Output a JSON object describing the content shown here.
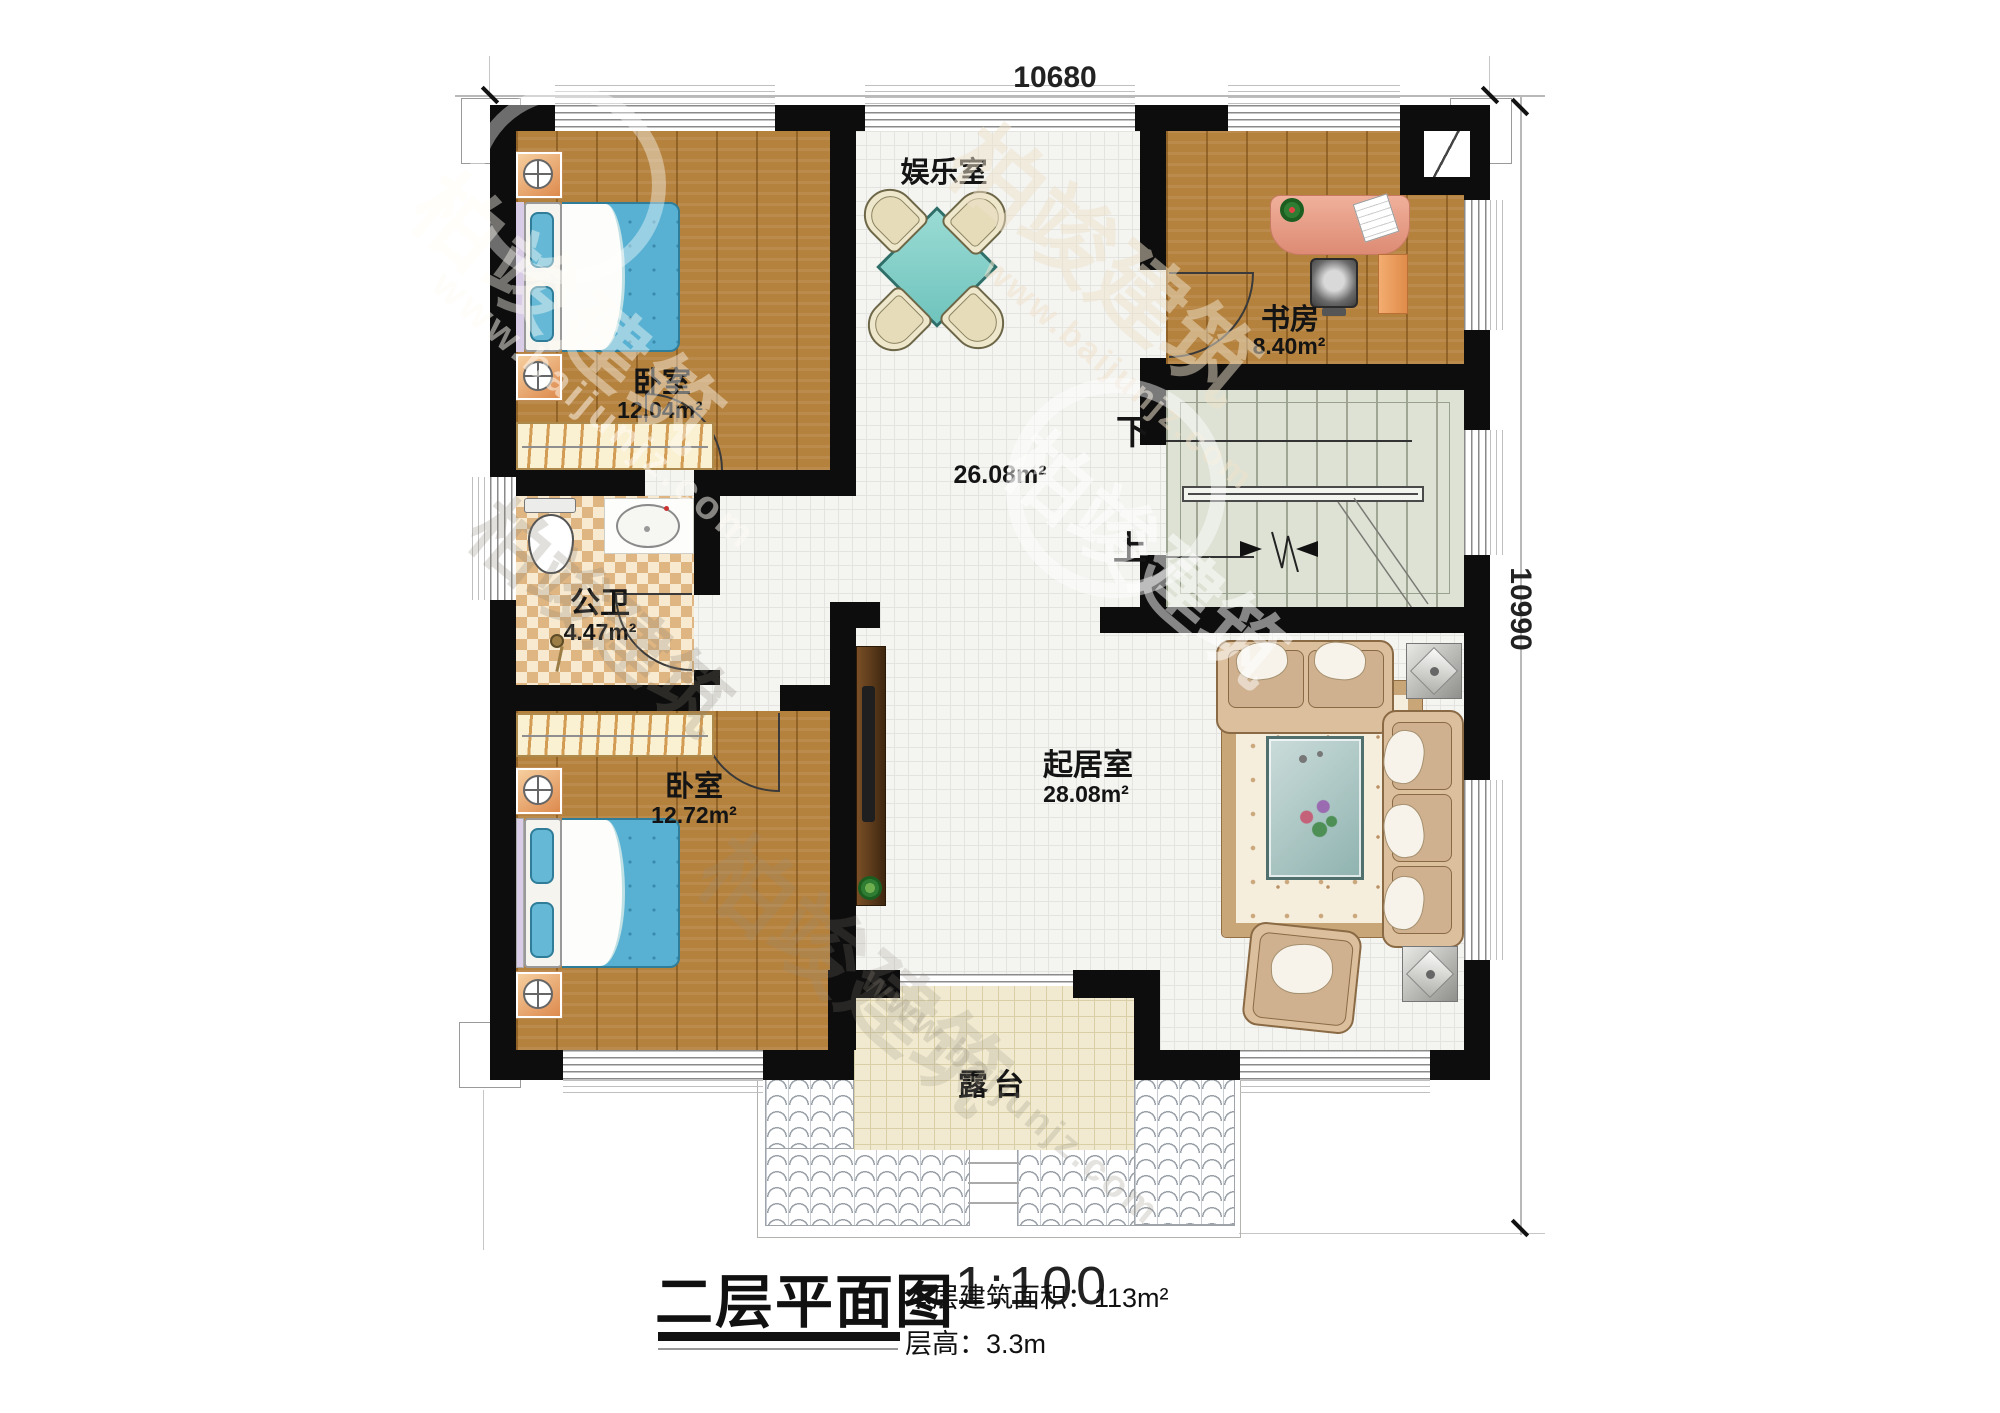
{
  "dimensions": {
    "top": "10680",
    "right": "10990"
  },
  "rooms": {
    "entertainment": {
      "name": "娱乐室"
    },
    "hall": {
      "area": "26.08m²"
    },
    "study": {
      "name": "书房",
      "area": "8.40m²"
    },
    "bedroom_top": {
      "name": "卧室",
      "area": "12.04m²"
    },
    "bathroom": {
      "name": "公卫",
      "area": "4.47m²"
    },
    "bedroom_bottom": {
      "name": "卧室",
      "area": "12.72m²"
    },
    "living": {
      "name": "起居室",
      "area": "28.08m²"
    },
    "terrace": {
      "name": "露台"
    }
  },
  "stairs": {
    "down_label": "下",
    "up_label": "上"
  },
  "title": {
    "main": "二层平面图",
    "scale": "1:100",
    "area": "本层建筑面积：113m²",
    "floor_height": "层高：3.3m"
  },
  "watermark": {
    "brand": "柏竣建筑",
    "url": "www.baijunjz.com"
  }
}
